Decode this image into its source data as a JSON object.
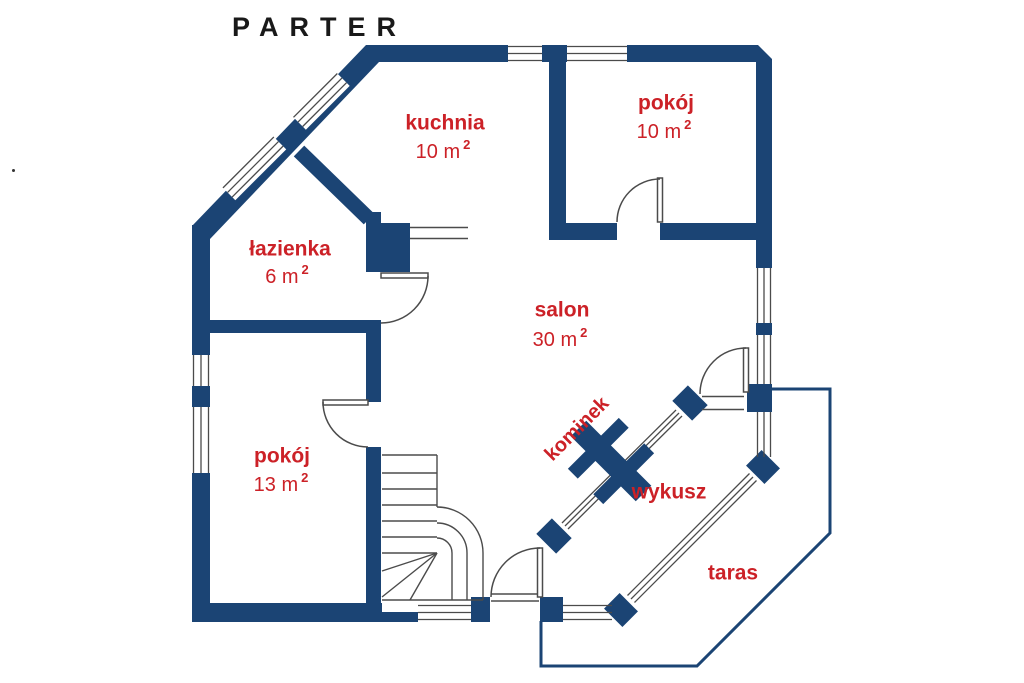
{
  "title": "PARTER",
  "colors": {
    "wall": "#1b4474",
    "label_red": "#cc2127",
    "thin_line": "#4b4b4b",
    "background": "#ffffff"
  },
  "rooms": {
    "kuchnia": {
      "name": "kuchnia",
      "area": "10 m",
      "area_sup": "2"
    },
    "pokoj_gorny": {
      "name": "pokój",
      "area": "10 m",
      "area_sup": "2"
    },
    "lazienka": {
      "name": "łazienka",
      "area": "6 m",
      "area_sup": "2"
    },
    "salon": {
      "name": "salon",
      "area": "30 m",
      "area_sup": "2"
    },
    "pokoj_dolny": {
      "name": "pokój",
      "area": "13 m",
      "area_sup": "2"
    }
  },
  "features": {
    "kominek": {
      "name": "kominek"
    },
    "wykusz": {
      "name": "wykusz"
    },
    "taras": {
      "name": "taras"
    }
  }
}
